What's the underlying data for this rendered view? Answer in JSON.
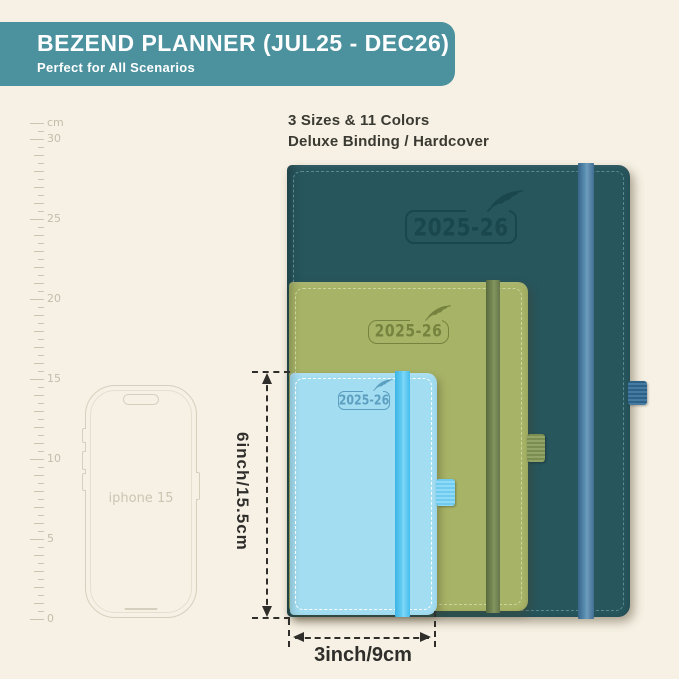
{
  "header": {
    "title": "BEZEND PLANNER (JUL25 - DEC26)",
    "subtitle": "Perfect for All Scenarios",
    "bg_color": "#4b919e",
    "text_color": "#ffffff"
  },
  "tagline": {
    "line1": "3 Sizes & 11 Colors",
    "line2": "Deluxe Binding / Hardcover"
  },
  "ruler": {
    "unit": "cm",
    "major_labels": [
      "30",
      "25",
      "20",
      "15",
      "10",
      "5",
      "0"
    ],
    "cm_between_majors": 5,
    "tick_color": "#cbc5b2",
    "label_color": "#c3bdaa"
  },
  "phone": {
    "label": "iphone 15",
    "outline_color": "#d5cfbd"
  },
  "planners": [
    {
      "size": "large",
      "year_label": "2025-26",
      "cover_color": "#27565d",
      "band_color": "#4a7da0",
      "stitch_color": "#5d8890",
      "emboss_color": "#1a464e",
      "pen_loop_color": "#2e6187"
    },
    {
      "size": "medium",
      "year_label": "2025-26",
      "cover_color": "#a7b366",
      "band_color": "#68794b",
      "stitch_color": "#ccd59d",
      "emboss_color": "#76833f",
      "pen_loop_color": "#7b8d51"
    },
    {
      "size": "small",
      "year_label": "2025-26",
      "cover_color": "#a3ddf1",
      "band_color": "#4ec3ef",
      "stitch_color": "#ffffff",
      "emboss_color": "#5d9fc0",
      "pen_loop_color": "#6fcbf0"
    }
  ],
  "dimensions": {
    "height_label": "6inch/15.5cm",
    "width_label": "3inch/9cm",
    "line_color": "#2f2e2b"
  },
  "background_color": "#f6f1e4"
}
